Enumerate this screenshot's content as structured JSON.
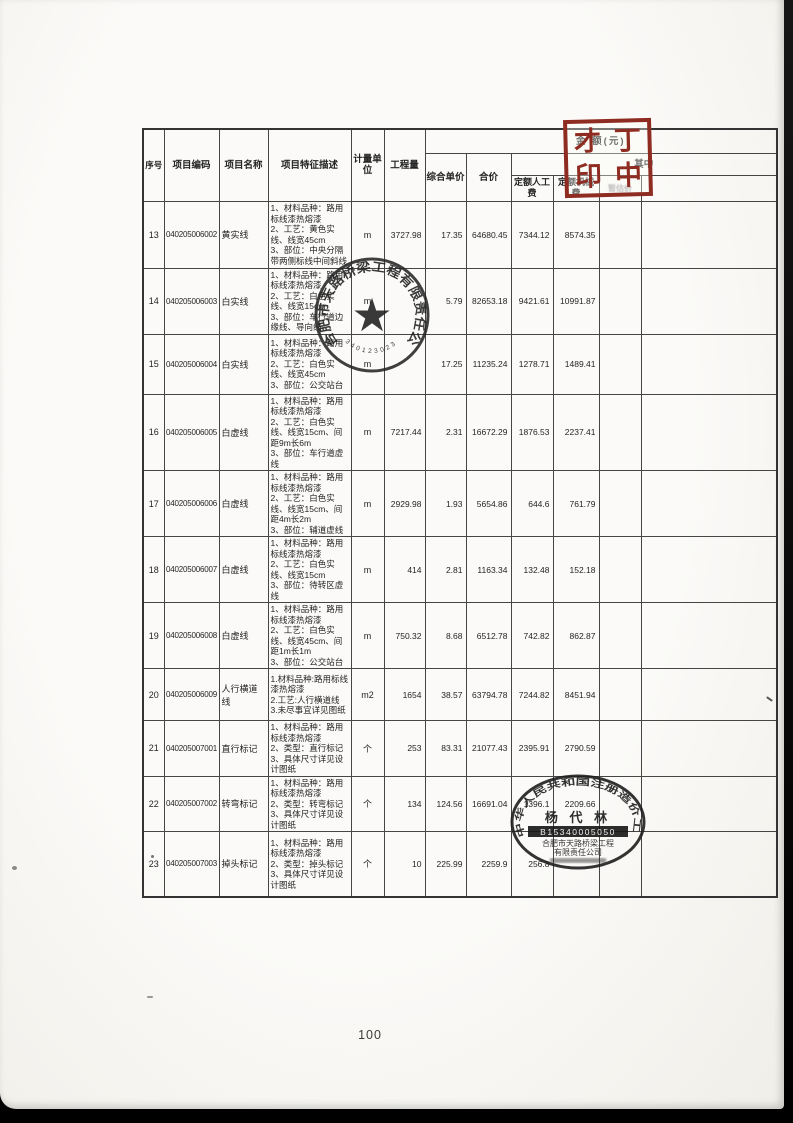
{
  "page_number": "100",
  "table": {
    "header": {
      "seq": "序号",
      "code": "项目编码",
      "name": "项目名称",
      "features": "项目特征描述",
      "unit": "计量单位",
      "quantity": "工程量",
      "amount_group": "金 额(元)",
      "unit_price": "综合单价",
      "total_price": "合价",
      "among": "其中",
      "labor": "定额人工费",
      "machine": "定额机械费",
      "provisional": "暂估价"
    },
    "rows": [
      {
        "seq": "13",
        "code": "040205006002",
        "name": "黄实线",
        "features": [
          "1、材料品种：路用标线漆热熔漆",
          "2、工艺：黄色实线、线宽45cm",
          "3、部位：中央分隔带两侧标线中间斜线"
        ],
        "unit": "m",
        "quantity": "3727.98",
        "unit_price": "17.35",
        "total": "64680.45",
        "labor": "7344.12",
        "machine": "8574.35"
      },
      {
        "seq": "14",
        "code": "040205006003",
        "name": "白实线",
        "features": [
          "1、材料品种：路用标线漆热熔漆",
          "2、工艺：白色实线、线宽15cm",
          "3、部位：车行道边缘线、导向线"
        ],
        "unit": "m",
        "quantity": "",
        "unit_price": "5.79",
        "total": "82653.18",
        "labor": "9421.61",
        "machine": "10991.87"
      },
      {
        "seq": "15",
        "code": "040205006004",
        "name": "白实线",
        "features": [
          "1、材料品种：路用标线漆热熔漆",
          "2、工艺：白色实线、线宽45cm",
          "3、部位：公交站台"
        ],
        "unit": "m",
        "quantity": "",
        "unit_price": "17.25",
        "total": "11235.24",
        "labor": "1278.71",
        "machine": "1489.41"
      },
      {
        "seq": "16",
        "code": "040205006005",
        "name": "白虚线",
        "features": [
          "1、材料品种：路用标线漆热熔漆",
          "2、工艺：白色实线、线宽15cm、间距9m长6m",
          "3、部位：车行道虚线"
        ],
        "unit": "m",
        "quantity": "7217.44",
        "unit_price": "2.31",
        "total": "16672.29",
        "labor": "1876.53",
        "machine": "2237.41"
      },
      {
        "seq": "17",
        "code": "040205006006",
        "name": "白虚线",
        "features": [
          "1、材料品种：路用标线漆热熔漆",
          "2、工艺：白色实线、线宽15cm、间距4m长2m",
          "3、部位：辅道虚线"
        ],
        "unit": "m",
        "quantity": "2929.98",
        "unit_price": "1.93",
        "total": "5654.86",
        "labor": "644.6",
        "machine": "761.79"
      },
      {
        "seq": "18",
        "code": "040205006007",
        "name": "白虚线",
        "features": [
          "1、材料品种：路用标线漆热熔漆",
          "2、工艺：白色实线、线宽15cm",
          "3、部位：待转区虚线"
        ],
        "unit": "m",
        "quantity": "414",
        "unit_price": "2.81",
        "total": "1163.34",
        "labor": "132.48",
        "machine": "152.18"
      },
      {
        "seq": "19",
        "code": "040205006008",
        "name": "白虚线",
        "features": [
          "1、材料品种：路用标线漆热熔漆",
          "2、工艺：白色实线、线宽45cm、间距1m长1m",
          "3、部位：公交站台"
        ],
        "unit": "m",
        "quantity": "750.32",
        "unit_price": "8.68",
        "total": "6512.78",
        "labor": "742.82",
        "machine": "862.87"
      },
      {
        "seq": "20",
        "code": "040205006009",
        "name": "人行横道线",
        "features": [
          "1.材料品种:路用标线漆热熔漆",
          "2.工艺:人行横道线",
          "3.未尽事宜详见图纸"
        ],
        "unit": "m2",
        "quantity": "1654",
        "unit_price": "38.57",
        "total": "63794.78",
        "labor": "7244.82",
        "machine": "8451.94"
      },
      {
        "seq": "21",
        "code": "040205007001",
        "name": "直行标记",
        "features": [
          "1、材料品种：路用标线漆热熔漆",
          "2、类型：直行标记",
          "3、具体尺寸详见设计图纸"
        ],
        "unit": "个",
        "quantity": "253",
        "unit_price": "83.31",
        "total": "21077.43",
        "labor": "2395.91",
        "machine": "2790.59"
      },
      {
        "seq": "22",
        "code": "040205007002",
        "name": "转弯标记",
        "features": [
          "1、材料品种：路用标线漆热熔漆",
          "2、类型：转弯标记",
          "3、具体尺寸详见设计图纸"
        ],
        "unit": "个",
        "quantity": "134",
        "unit_price": "124.56",
        "total": "16691.04",
        "labor": "1396.1",
        "machine": "2209.66"
      },
      {
        "seq": "23",
        "code": "040205007003",
        "name": "掉头标记",
        "features": [
          "1、材料品种：路用标线漆热熔漆",
          "2、类型：掉头标记",
          "3、具体尺寸详见设计图纸"
        ],
        "unit": "个",
        "quantity": "10",
        "unit_price": "225.99",
        "total": "2259.9",
        "labor": "256.8",
        "machine": ""
      }
    ]
  },
  "stamps": {
    "print_stamp": {
      "char1": "才",
      "char2": "丁",
      "char3": "印",
      "char4": "中",
      "color": "#8f2c22"
    },
    "company_seal": {
      "ring_text": "合肥市天路桥梁工程有限责任公司",
      "star": "★",
      "number": "3401230235520"
    },
    "engineer_seal": {
      "ring_text": "中华人民共和国注册造价工程师",
      "name": "杨 代 林",
      "number": "B15340005050",
      "org_line1": "合肥市天路桥梁工程",
      "org_line2": "有限责任公司"
    }
  }
}
